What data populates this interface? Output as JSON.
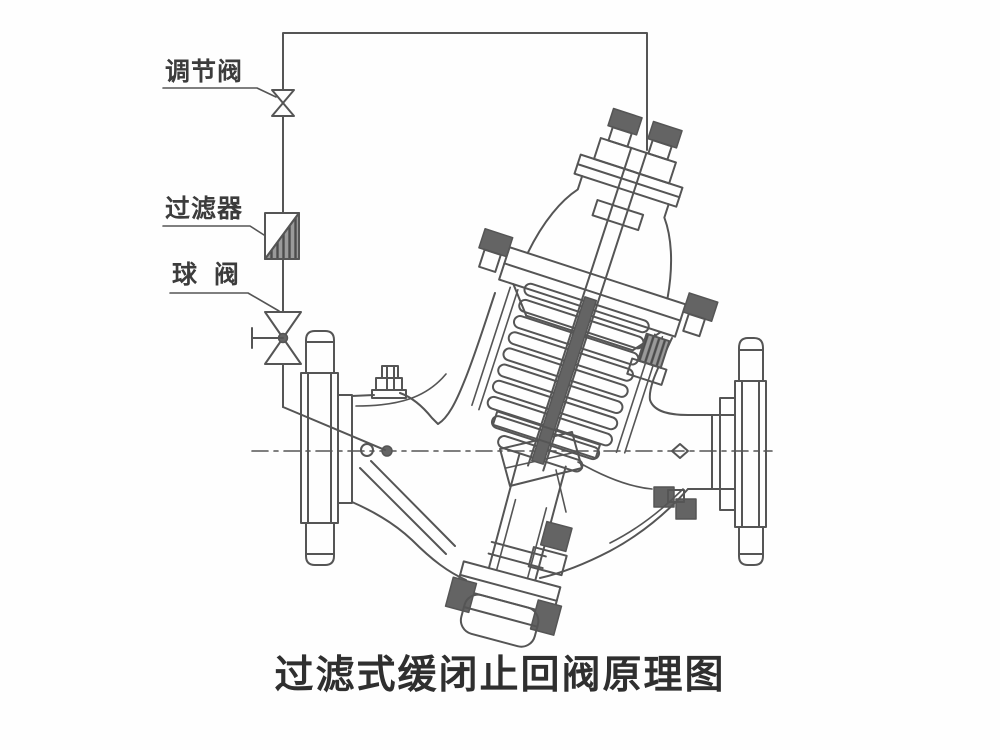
{
  "diagram": {
    "title": "过滤式缓闭止回阀原理图",
    "labels": {
      "regulating_valve": "调节阀",
      "filter": "过滤器",
      "ball_valve": "球  阀"
    },
    "colors": {
      "line": "#555555",
      "dark_fill": "#646464",
      "background": "#fefefe",
      "text": "#3c3c3c"
    }
  }
}
